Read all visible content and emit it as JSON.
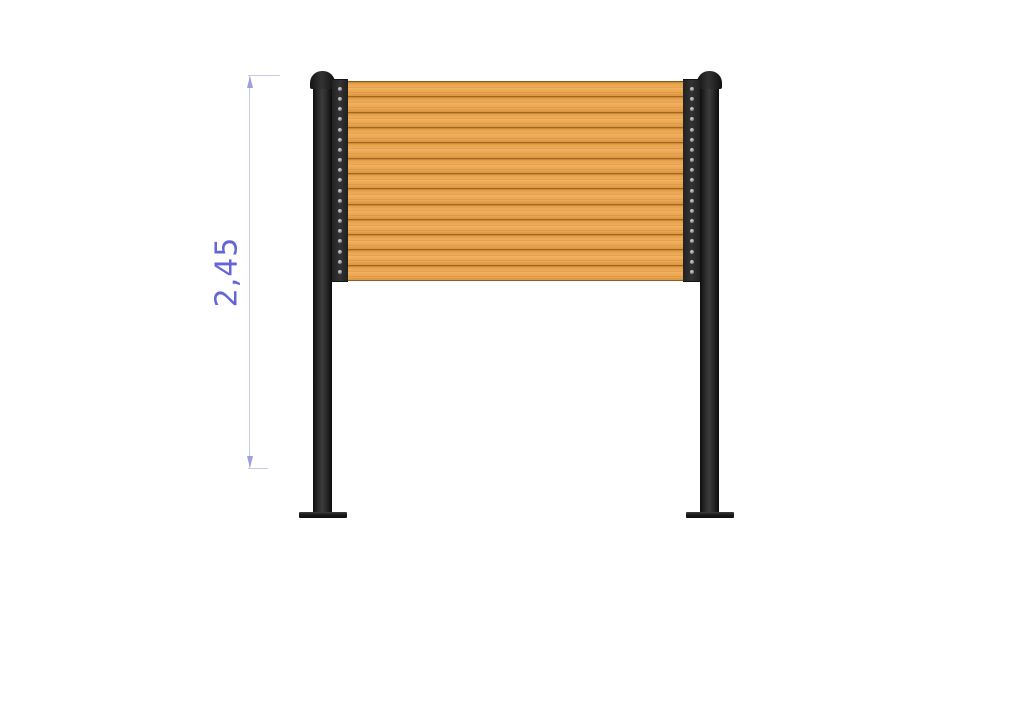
{
  "dimension": {
    "label": "2,45",
    "orientation": "vertical"
  },
  "structure": {
    "panel": {
      "slat_count": 13,
      "material": "wood-slats"
    },
    "posts": {
      "count": 2,
      "rivets_per_strip": 19,
      "has_base_plates": true,
      "has_rounded_caps": true
    }
  },
  "colors": {
    "background": "#ffffff",
    "wood_base": "#eba54f",
    "wood_light": "#f1af5c",
    "wood_dark": "#d18c35",
    "wood_dark2": "#dd9640",
    "post_dark": "#1c1c1c",
    "rivet": "#9a9a9a",
    "dimension_line": "#c9c9ec",
    "dimension_arrow": "#9e9ee2",
    "dimension_label": "#6565d8"
  }
}
